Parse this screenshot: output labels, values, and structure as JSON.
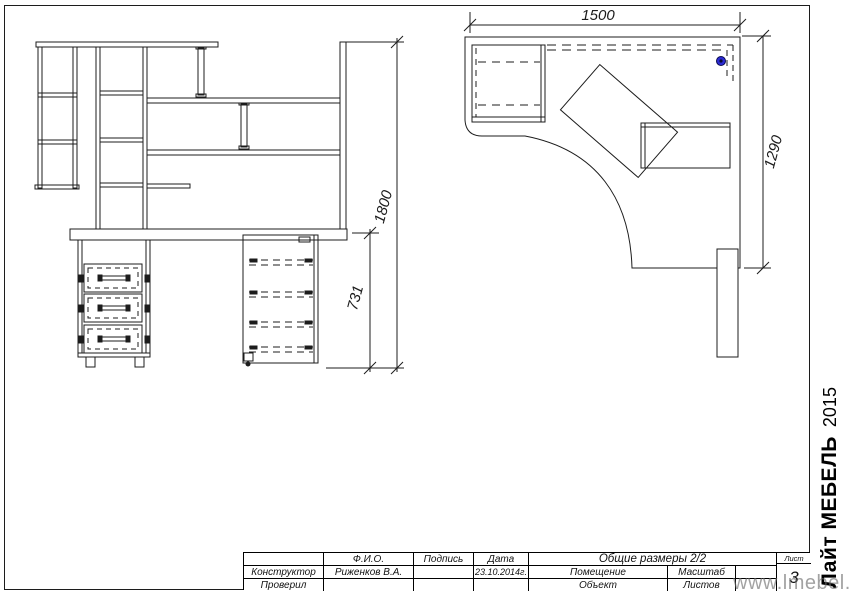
{
  "views": {
    "front_view": {
      "dims": {
        "total_height": "1800",
        "desk_height": "731"
      }
    },
    "plan_view": {
      "dims": {
        "width": "1500",
        "depth": "1290"
      },
      "marker_color": "#2b2bd4"
    }
  },
  "title_block": {
    "headers": {
      "fio": "Ф.И.О.",
      "signature": "Подпись",
      "date": "Дата",
      "doc_title": "Общие размеры 2/2",
      "sheet": "Лист"
    },
    "cells": {
      "constructor_label": "Конструктор",
      "constructor_name": "Риженков В.А.",
      "date_value": "23.10.2014г.",
      "room_label": "Помещение",
      "scale_label": "Масштаб",
      "checked_label": "Проверил",
      "object_label": "Объект",
      "sheets_label": "Листов",
      "sheet_number": "3"
    }
  },
  "branding": {
    "brand": "Лайт МЕБЕЛЬ",
    "year": "2015"
  },
  "watermark": {
    "text": "www.lmebel.by"
  }
}
